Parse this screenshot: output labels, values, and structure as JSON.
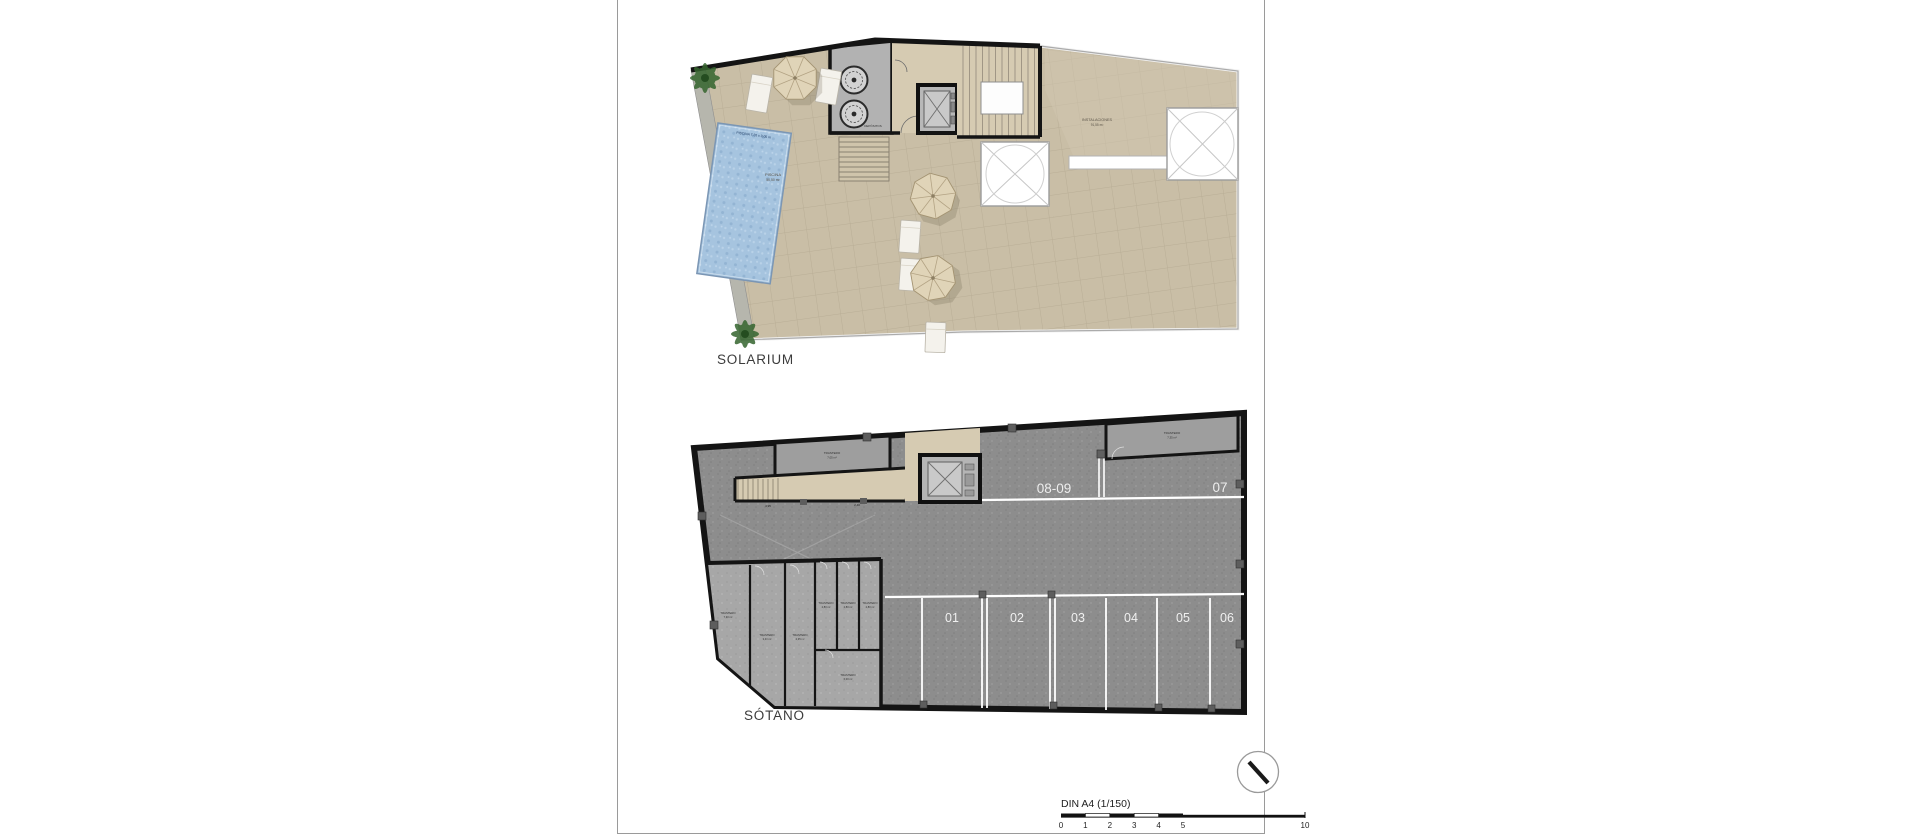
{
  "solarium": {
    "title": "SOLARIUM",
    "pool": {
      "dim_label": "PISCINA 7,20 x 3,05 m",
      "name": "PISCINA",
      "area": "50,50 m²"
    },
    "instalaciones": {
      "name": "INSTALACIONES",
      "area": "91,55 m²"
    },
    "depositos_label": "DEPÓSITOS"
  },
  "sotano": {
    "title": "SÓTANO",
    "storage_top_left": {
      "name": "TRASTERO",
      "area": "7,05 m²"
    },
    "storage_top_right": {
      "name": "TRASTERO",
      "area": "7,35 m²"
    },
    "storage_block": [
      {
        "name": "TRASTERO",
        "area": "7,30 m²"
      },
      {
        "name": "TRASTERO",
        "area": "3,40 m²"
      },
      {
        "name": "TRASTERO",
        "area": "2,35 m²"
      },
      {
        "name": "TRASTERO",
        "area": "2,80 m²"
      },
      {
        "name": "TRASTERO",
        "area": "2,80 m²"
      },
      {
        "name": "TRASTERO",
        "area": "2,80 m²"
      },
      {
        "name": "TRASTERO",
        "area": "6,00 m²"
      }
    ],
    "parking_spots": [
      "01",
      "02",
      "03",
      "04",
      "05",
      "06"
    ],
    "parking_spots_top": [
      "08-09",
      "07"
    ],
    "dimensions": [
      "4,95",
      "2,40"
    ]
  },
  "footer": {
    "scale_label": "DIN A4 (1/150)",
    "scale_ticks": [
      "0",
      "1",
      "2",
      "3",
      "4",
      "5",
      "10"
    ]
  },
  "colors": {
    "terrace_beige": "#c9bea6",
    "pool_water": "#a6c4df",
    "basement_floor": "#8d8d8d",
    "storage_floor": "#a7a7a7",
    "hall_beige": "#d6cbb2",
    "wall_black": "#141414",
    "marking_white": "#ffffff"
  }
}
